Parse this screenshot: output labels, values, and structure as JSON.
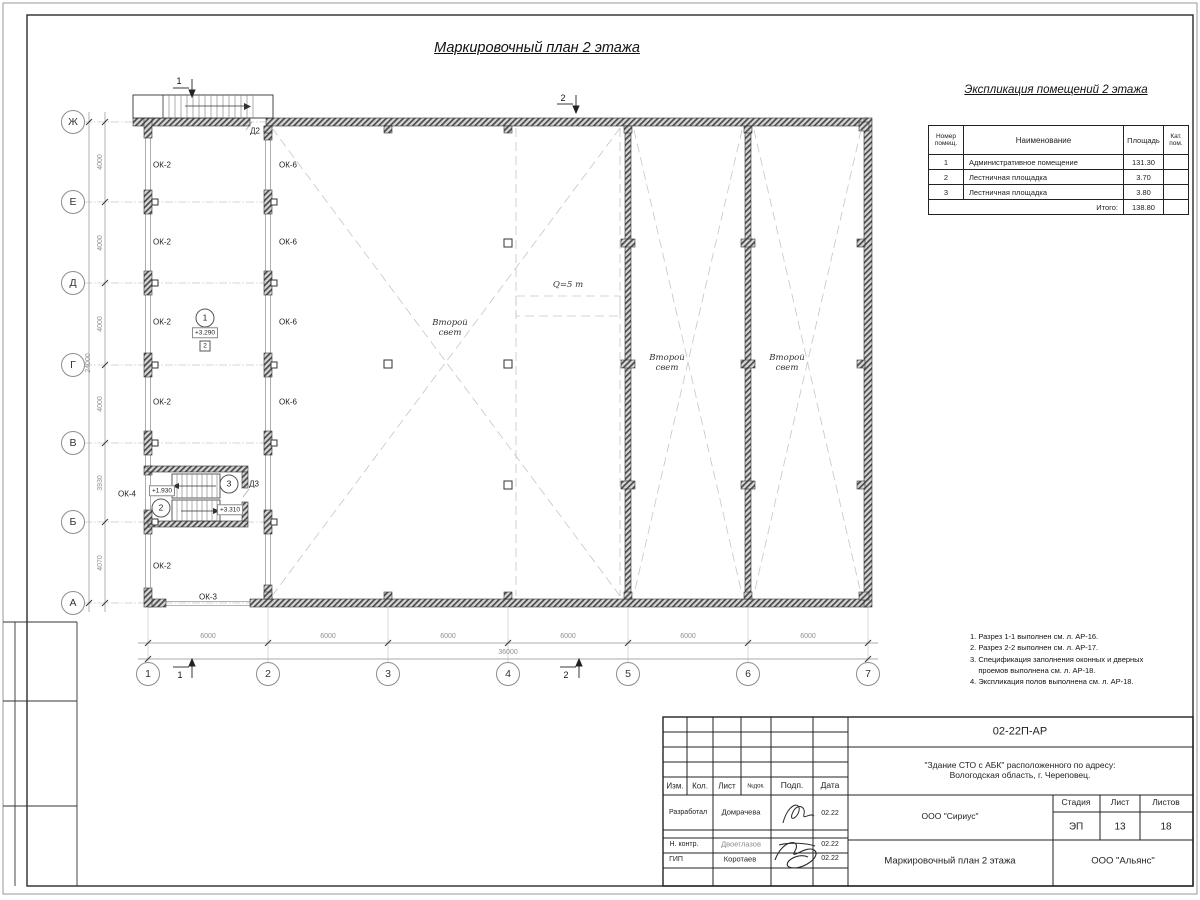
{
  "main": {
    "title": "Маркировочный план 2 этажа"
  },
  "room_table": {
    "title": "Экспликация помещений 2 этажа",
    "headers": {
      "num": "Номер\nпомещ.",
      "name": "Наименование",
      "area": "Площадь",
      "cat": "Кат.\nпом."
    },
    "rows": [
      {
        "num": "1",
        "name": "Административное помещение",
        "area": "131.30",
        "cat": ""
      },
      {
        "num": "2",
        "name": "Лестничная площадка",
        "area": "3.70",
        "cat": ""
      },
      {
        "num": "3",
        "name": "Лестничная площадка",
        "area": "3.80",
        "cat": ""
      }
    ],
    "total_label": "Итого:",
    "total": "138.80"
  },
  "notes_text": "1. Разрез 1-1 выполнен см. л. АР-16.\n2. Разрез 2-2 выполнен см. л. АР-17.\n3. Спецификация заполнения оконных и дверных\n    проемов выполнена см. л. АР-18.\n4. Экспликация полов выполнена см. л. АР-18.",
  "colors": {
    "line": "#222222",
    "wall_hatch": "#4a4a4a",
    "dashed": "#c6c6c6",
    "dim_text": "#8f8f8f"
  },
  "plan": {
    "annotations": [
      {
        "t": "Ж",
        "x": 73,
        "y": 122,
        "k": "axis",
        "n": "axis-row-zh"
      },
      {
        "t": "Е",
        "x": 73,
        "y": 202,
        "k": "axis",
        "n": "axis-row-e"
      },
      {
        "t": "Д",
        "x": 73,
        "y": 283,
        "k": "axis",
        "n": "axis-row-d"
      },
      {
        "t": "Г",
        "x": 73,
        "y": 365,
        "k": "axis",
        "n": "axis-row-g"
      },
      {
        "t": "В",
        "x": 73,
        "y": 443,
        "k": "axis",
        "n": "axis-row-v"
      },
      {
        "t": "Б",
        "x": 73,
        "y": 522,
        "k": "axis",
        "n": "axis-row-b"
      },
      {
        "t": "А",
        "x": 73,
        "y": 603,
        "k": "axis",
        "n": "axis-row-a"
      },
      {
        "t": "1",
        "x": 148,
        "y": 674,
        "k": "axis",
        "n": "axis-col-1"
      },
      {
        "t": "2",
        "x": 268,
        "y": 674,
        "k": "axis",
        "n": "axis-col-2"
      },
      {
        "t": "3",
        "x": 388,
        "y": 674,
        "k": "axis",
        "n": "axis-col-3"
      },
      {
        "t": "4",
        "x": 508,
        "y": 674,
        "k": "axis",
        "n": "axis-col-4"
      },
      {
        "t": "5",
        "x": 628,
        "y": 674,
        "k": "axis",
        "n": "axis-col-5"
      },
      {
        "t": "6",
        "x": 748,
        "y": 674,
        "k": "axis",
        "n": "axis-col-6"
      },
      {
        "t": "7",
        "x": 868,
        "y": 674,
        "k": "axis",
        "n": "axis-col-7"
      },
      {
        "t": "6000",
        "x": 208,
        "y": 637,
        "k": "dimh",
        "n": "dim-span-1-2"
      },
      {
        "t": "6000",
        "x": 328,
        "y": 637,
        "k": "dimh",
        "n": "dim-span-2-3"
      },
      {
        "t": "6000",
        "x": 448,
        "y": 637,
        "k": "dimh",
        "n": "dim-span-3-4"
      },
      {
        "t": "6000",
        "x": 568,
        "y": 637,
        "k": "dimh",
        "n": "dim-span-4-5"
      },
      {
        "t": "6000",
        "x": 688,
        "y": 637,
        "k": "dimh",
        "n": "dim-span-5-6"
      },
      {
        "t": "6000",
        "x": 808,
        "y": 637,
        "k": "dimh",
        "n": "dim-span-6-7"
      },
      {
        "t": "36000",
        "x": 508,
        "y": 653,
        "k": "dimh",
        "n": "dim-total-width"
      },
      {
        "t": "4000",
        "x": 101,
        "y": 162,
        "k": "dimv",
        "n": "dim-span-zh-e"
      },
      {
        "t": "4000",
        "x": 101,
        "y": 243,
        "k": "dimv",
        "n": "dim-span-e-d"
      },
      {
        "t": "4000",
        "x": 101,
        "y": 324,
        "k": "dimv",
        "n": "dim-span-d-g"
      },
      {
        "t": "4000",
        "x": 101,
        "y": 404,
        "k": "dimv",
        "n": "dim-span-g-v"
      },
      {
        "t": "3930",
        "x": 101,
        "y": 483,
        "k": "dimv",
        "n": "dim-span-v-b"
      },
      {
        "t": "4070",
        "x": 101,
        "y": 563,
        "k": "dimv",
        "n": "dim-span-b-a"
      },
      {
        "t": "24000",
        "x": 89,
        "y": 363,
        "k": "dimv",
        "n": "dim-total-depth"
      },
      {
        "t": "ОК-2",
        "x": 162,
        "y": 165,
        "k": "label",
        "n": "window-mark-ok2"
      },
      {
        "t": "ОК-2",
        "x": 162,
        "y": 242,
        "k": "label",
        "n": "window-mark-ok2"
      },
      {
        "t": "ОК-2",
        "x": 162,
        "y": 322,
        "k": "label",
        "n": "window-mark-ok2"
      },
      {
        "t": "ОК-2",
        "x": 162,
        "y": 402,
        "k": "label",
        "n": "window-mark-ok2"
      },
      {
        "t": "ОК-2",
        "x": 162,
        "y": 566,
        "k": "label",
        "n": "window-mark-ok2"
      },
      {
        "t": "ОК-6",
        "x": 288,
        "y": 165,
        "k": "label",
        "n": "window-mark-ok6"
      },
      {
        "t": "ОК-6",
        "x": 288,
        "y": 242,
        "k": "label",
        "n": "window-mark-ok6"
      },
      {
        "t": "ОК-6",
        "x": 288,
        "y": 322,
        "k": "label",
        "n": "window-mark-ok6"
      },
      {
        "t": "ОК-6",
        "x": 288,
        "y": 402,
        "k": "label",
        "n": "window-mark-ok6"
      },
      {
        "t": "ОК-4",
        "x": 127,
        "y": 494,
        "k": "label",
        "n": "window-mark-ok4"
      },
      {
        "t": "ОК-3",
        "x": 208,
        "y": 597,
        "k": "label",
        "n": "window-mark-ok3"
      },
      {
        "t": "Д2",
        "x": 255,
        "y": 131,
        "k": "label",
        "n": "door-mark-d2"
      },
      {
        "t": "Д3",
        "x": 254,
        "y": 484,
        "k": "label",
        "n": "door-mark-d3"
      },
      {
        "t": "1",
        "x": 205,
        "y": 318,
        "k": "mark",
        "n": "room-number-1"
      },
      {
        "t": "+3.290",
        "x": 205,
        "y": 333,
        "k": "box",
        "n": "elevation-3290"
      },
      {
        "t": "2",
        "x": 205,
        "y": 346,
        "k": "sbox",
        "n": "zone-mark-2"
      },
      {
        "t": "2",
        "x": 161,
        "y": 508,
        "k": "mark",
        "n": "room-number-2"
      },
      {
        "t": "3",
        "x": 229,
        "y": 484,
        "k": "mark",
        "n": "room-number-3"
      },
      {
        "t": "+1.930",
        "x": 162,
        "y": 491,
        "k": "box",
        "n": "elevation-1930"
      },
      {
        "t": "+3.310",
        "x": 230,
        "y": 510,
        "k": "box",
        "n": "elevation-3310"
      },
      {
        "t": "Второй\nсвет",
        "x": 450,
        "y": 329,
        "k": "it",
        "n": "void-label"
      },
      {
        "t": "Второй\nсвет",
        "x": 667,
        "y": 364,
        "k": "it",
        "n": "void-label"
      },
      {
        "t": "Второй\nсвет",
        "x": 787,
        "y": 364,
        "k": "it",
        "n": "void-label"
      },
      {
        "t": "Q=5 т",
        "x": 568,
        "y": 286,
        "k": "it",
        "n": "crane-capacity-label"
      },
      {
        "t": "1",
        "x": 179,
        "y": 81,
        "k": "sec",
        "n": "section-mark-1-top"
      },
      {
        "t": "2",
        "x": 563,
        "y": 98,
        "k": "sec",
        "n": "section-mark-2-top"
      },
      {
        "t": "1",
        "x": 180,
        "y": 675,
        "k": "sec",
        "n": "section-mark-1-bottom"
      },
      {
        "t": "2",
        "x": 566,
        "y": 675,
        "k": "sec",
        "n": "section-mark-2-bottom"
      }
    ]
  },
  "titleblock": {
    "texts": [
      {
        "t": "Изм.",
        "x": 675,
        "y": 786,
        "k": "label",
        "fs": 8,
        "n": "tb-col-izm"
      },
      {
        "t": "Кол.",
        "x": 700,
        "y": 786,
        "k": "label",
        "fs": 8,
        "n": "tb-col-kol"
      },
      {
        "t": "Лист",
        "x": 727,
        "y": 786,
        "k": "label",
        "fs": 8,
        "n": "tb-col-list"
      },
      {
        "t": "№док.",
        "x": 756,
        "y": 787,
        "k": "label",
        "fs": 6,
        "n": "tb-col-ndok"
      },
      {
        "t": "Подп.",
        "x": 792,
        "y": 786,
        "k": "label",
        "fs": 8.5,
        "n": "tb-col-podp"
      },
      {
        "t": "Дата",
        "x": 830,
        "y": 786,
        "k": "label",
        "fs": 8.5,
        "n": "tb-col-data"
      },
      {
        "t": "Разработал",
        "x": 688,
        "y": 813,
        "k": "label",
        "fs": 7,
        "n": "tb-role-developer"
      },
      {
        "t": "Домрачева",
        "x": 741,
        "y": 813,
        "k": "label",
        "fs": 7.5,
        "n": "tb-name-developer"
      },
      {
        "t": "02.22",
        "x": 830,
        "y": 814,
        "k": "label",
        "fs": 7,
        "n": "tb-date-developer"
      },
      {
        "t": "Н. контр.",
        "x": 684,
        "y": 845,
        "k": "label",
        "fs": 7,
        "n": "tb-role-ncontrol"
      },
      {
        "t": "Двоеглазов",
        "x": 741,
        "y": 845,
        "k": "label",
        "fs": 7.5,
        "c": "#8a8a8a",
        "n": "tb-name-ncontrol"
      },
      {
        "t": "02.22",
        "x": 830,
        "y": 845,
        "k": "label",
        "fs": 7,
        "n": "tb-date-ncontrol"
      },
      {
        "t": "ГИП",
        "x": 676,
        "y": 860,
        "k": "label",
        "fs": 7,
        "n": "tb-role-gip"
      },
      {
        "t": "Коротаев",
        "x": 740,
        "y": 860,
        "k": "label",
        "fs": 7.5,
        "n": "tb-name-gip"
      },
      {
        "t": "02.22",
        "x": 830,
        "y": 859,
        "k": "label",
        "fs": 7,
        "n": "tb-date-gip"
      },
      {
        "t": "02-22П-АР",
        "x": 1020,
        "y": 732,
        "k": "label",
        "fs": 11,
        "n": "tb-doc-code"
      },
      {
        "t": "\"Здание СТО с АБК\" расположенного по адресу:\nВологодская область, г. Череповец.",
        "x": 1020,
        "y": 771,
        "k": "label",
        "fs": 8.5,
        "n": "tb-object-address"
      },
      {
        "t": "ООО \"Сириус\"",
        "x": 950,
        "y": 817,
        "k": "label",
        "fs": 8.5,
        "n": "tb-company-sirius"
      },
      {
        "t": "Стадия",
        "x": 1076,
        "y": 803,
        "k": "label",
        "fs": 8.5,
        "n": "tb-stage-label"
      },
      {
        "t": "Лист",
        "x": 1120,
        "y": 803,
        "k": "label",
        "fs": 8.5,
        "n": "tb-sheet-label"
      },
      {
        "t": "Листов",
        "x": 1166,
        "y": 803,
        "k": "label",
        "fs": 8.5,
        "n": "tb-sheets-label"
      },
      {
        "t": "ЭП",
        "x": 1076,
        "y": 827,
        "k": "label",
        "fs": 10,
        "n": "tb-stage-value"
      },
      {
        "t": "13",
        "x": 1120,
        "y": 827,
        "k": "label",
        "fs": 10,
        "n": "tb-sheet-value"
      },
      {
        "t": "18",
        "x": 1166,
        "y": 827,
        "k": "label",
        "fs": 10,
        "n": "tb-sheets-value"
      },
      {
        "t": "Маркировочный план 2 этажа",
        "x": 950,
        "y": 862,
        "k": "label",
        "fs": 9.5,
        "n": "tb-drawing-title"
      },
      {
        "t": "ООО \"Альянс\"",
        "x": 1123,
        "y": 862,
        "k": "label",
        "fs": 9.5,
        "n": "tb-company-alyans"
      }
    ]
  }
}
